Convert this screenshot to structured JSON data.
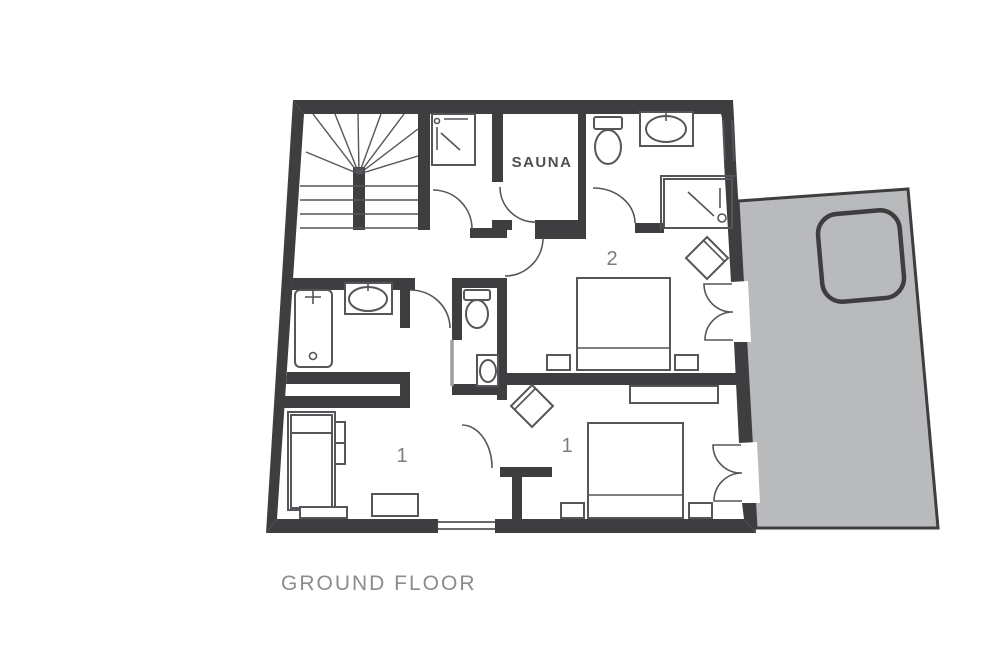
{
  "title": "GROUND FLOOR",
  "labels": {
    "sauna": "SAUNA",
    "bedroom_2": "2",
    "bedroom_1": "1",
    "lounge": "1"
  },
  "colors": {
    "wall": "#3e3e40",
    "line": "#55555a",
    "terrace_fill": "#b9babc",
    "terrace_border": "#3e3e40",
    "label": "#7d7d7d",
    "sauna_label": "#4f4f52",
    "title": "#8c8c8c",
    "door_leaf": "#9e9e9e",
    "background": "#ffffff"
  }
}
